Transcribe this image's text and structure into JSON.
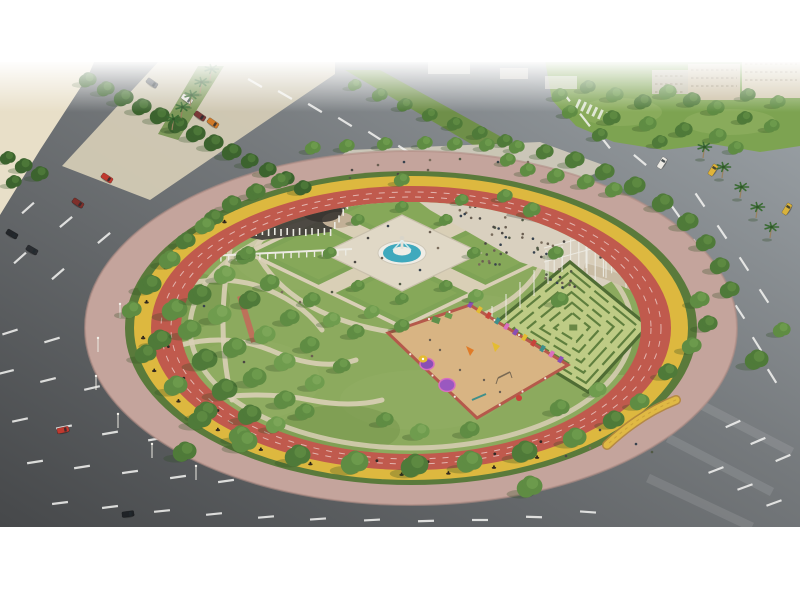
{
  "page": {
    "background": "#ffffff",
    "description": "Aerial architectural rendering of a large circular city park (roundabout park) surrounded by asphalt roads, with a central fountain garden, hedge maze, playground, crowd plaza with solar canopy, umbrella terrace, red running track ring, yellow cycle track ring and pink perimeter promenade."
  },
  "scene": {
    "features": [
      "circular-park",
      "running-track-ring",
      "cycle-track-ring",
      "perimeter-promenade",
      "hedge-ring",
      "formal-garden",
      "central-fountain",
      "dark-theme-garden",
      "red-roof-pavilion",
      "crowd-plaza",
      "solar-canopy",
      "pole-pergola",
      "umbrella-terrace",
      "hedge-maze",
      "playground",
      "entrance-bridge",
      "forest-paths",
      "perimeter-roads",
      "lane-markings",
      "cars",
      "palm-trees",
      "distant-buildings",
      "sand-lot"
    ]
  },
  "colors": {
    "page_bg": "#ffffff",
    "road_light": "#9ba3a9",
    "road_mid": "#75797c",
    "road_dark": "#4b4d4e",
    "lane_marking": "#f5f5f2",
    "sand": "#e8dfc8",
    "shoulder": "#d8cfb8",
    "grass": "#7da351",
    "grass_light": "#95b366",
    "park_green": "#8caa5e",
    "park_green_dark": "#6e8f47",
    "tree_palette": [
      "#3c632e",
      "#4f7a39",
      "#5f8c43",
      "#6f9c4e",
      "#7fa85a",
      "#8fb463"
    ],
    "palm_green": "#3a6b33",
    "trunk": "#9a8260",
    "sidewalk_pink": "#c4a49c",
    "hedge_green": "#5a7a3b",
    "cycle_yellow": "#ddb83f",
    "track_red": "#c05a4d",
    "path_beige": "#d9cfb6",
    "plaza_beige": "#d9d0bf",
    "entrance_paving": "#cfc9ba",
    "garden_paving": "#e0d8c6",
    "water_blue": "#3fa9bd",
    "fountain_white": "#efede6",
    "canopy_dark": "#232e38",
    "canopy_grid": "#8fa0ad",
    "maze_base": "#becb85",
    "maze_hedge": "#5f7f3e",
    "maze_wall": "#4f6c34",
    "playground_sand": "#d8b483",
    "playground_border": "#b5594b",
    "roof_red": "#b25a4b",
    "roof_ridge": "#8e4234",
    "building_beige": "#cfc0a8",
    "umbrella_white": "#f2f1ec",
    "terrace_tan": "#d5c9b2",
    "terrace_tan2": "#c9bca4",
    "dark_garden": "#46413d",
    "garden_blob": "#c8b69e",
    "accent_purple": "#8a4fb5",
    "accent_purple2": "#9a58c0",
    "accent_yellow": "#e4bc32",
    "accent_red": "#c8433a",
    "accent_teal": "#3f8f8a",
    "accent_pink": "#d86fc0",
    "accent_orange": "#e07b28",
    "bridge_tan": "#e0b944",
    "bridge_edge": "#b4863c",
    "white_structure": "#eceae2",
    "crowd_palette": [
      "#4a4743",
      "#6b5f52",
      "#37424e",
      "#7a6c5c",
      "#525a46"
    ]
  }
}
